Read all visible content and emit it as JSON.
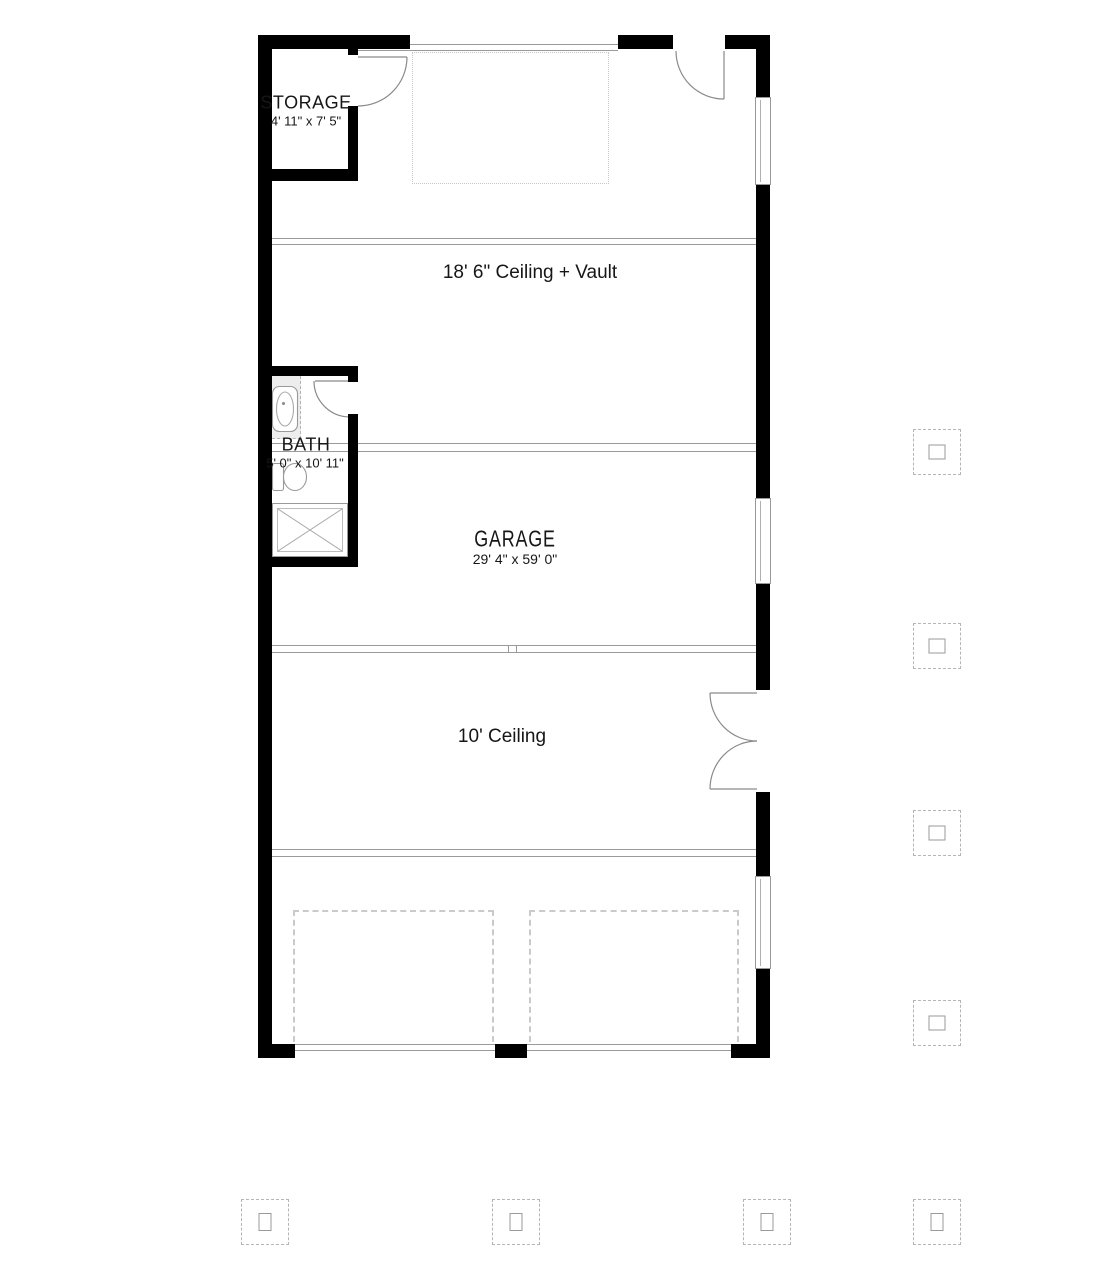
{
  "title": "Garage floor plan",
  "rooms": {
    "storage": {
      "name": "STORAGE",
      "dims": "4' 11\" x 7' 5\""
    },
    "bath": {
      "name": "BATH",
      "dims": "5' 0\" x 10' 11\""
    },
    "garage": {
      "name": "GARAGE",
      "dims": "29' 4\" x 59' 0\""
    }
  },
  "annotations": {
    "upper_ceiling": "18' 6\" Ceiling + Vault",
    "lower_ceiling": "10' Ceiling"
  },
  "fixtures": [
    "bathtub",
    "toilet",
    "shower"
  ],
  "features": {
    "windows_right_wall": 3,
    "window_top_wall_band": 1,
    "swing_doors": [
      "storage-door",
      "bath-door",
      "top-entry-door",
      "right-double-door"
    ],
    "garage_door_openings": 2,
    "parking_stalls_dashed": 2,
    "column_footing_markers": 8
  },
  "colors": {
    "wall": "#000000",
    "thin_line": "#9a9a9a",
    "dashed_line": "#b5b5b5",
    "stall_dash": "#cacaca",
    "text": "#161616",
    "fixture_stroke": "#8a8a8a",
    "tub_alcove_fill": "#ededed",
    "background": "#ffffff"
  }
}
